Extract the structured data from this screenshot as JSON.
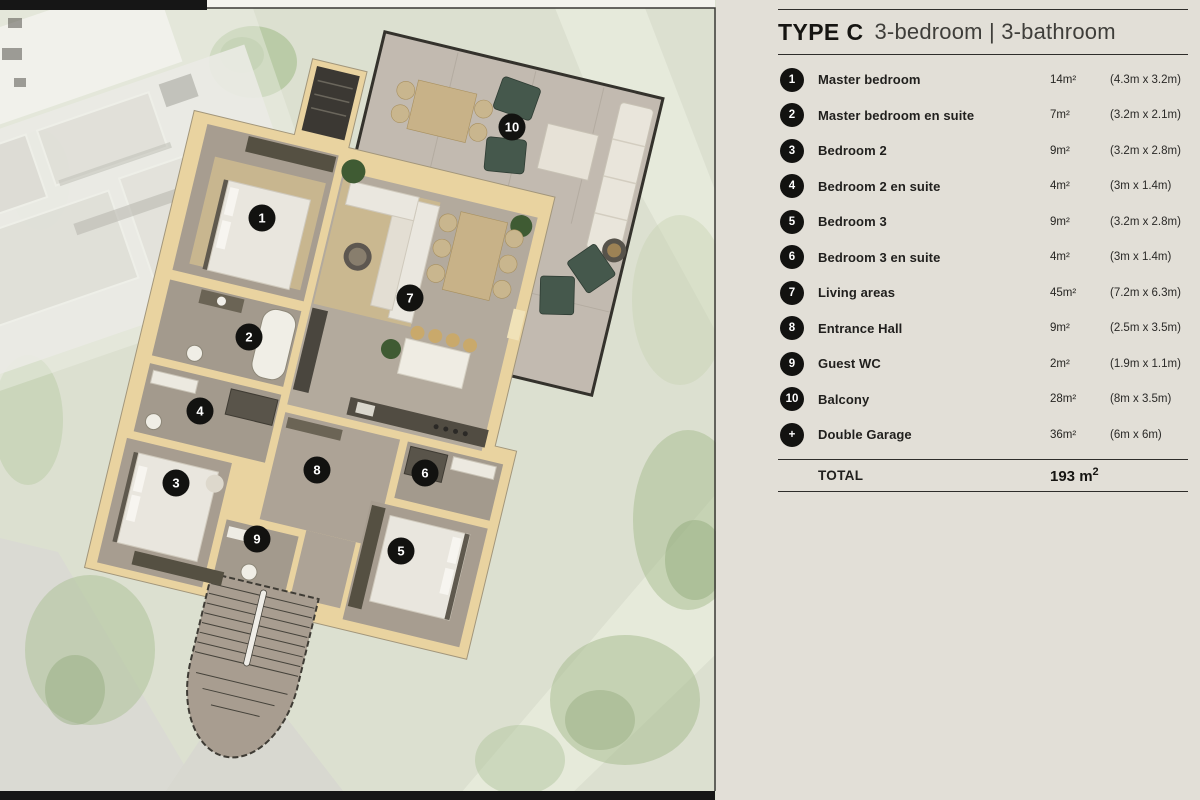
{
  "header": {
    "type": "TYPE C",
    "subtitle": "3-bedroom | 3-bathroom"
  },
  "legend": {
    "rows": [
      {
        "badge": "1",
        "name": "Master bedroom",
        "area": "14m²",
        "dims": "(4.3m x 3.2m)"
      },
      {
        "badge": "2",
        "name": "Master bedroom en suite",
        "area": "7m²",
        "dims": "(3.2m x 2.1m)"
      },
      {
        "badge": "3",
        "name": "Bedroom 2",
        "area": "9m²",
        "dims": "(3.2m x 2.8m)"
      },
      {
        "badge": "4",
        "name": "Bedroom 2 en suite",
        "area": "4m²",
        "dims": "(3m x 1.4m)"
      },
      {
        "badge": "5",
        "name": "Bedroom 3",
        "area": "9m²",
        "dims": "(3.2m x 2.8m)"
      },
      {
        "badge": "6",
        "name": "Bedroom 3 en suite",
        "area": "4m²",
        "dims": "(3m x 1.4m)"
      },
      {
        "badge": "7",
        "name": "Living areas",
        "area": "45m²",
        "dims": "(7.2m x 6.3m)"
      },
      {
        "badge": "8",
        "name": "Entrance Hall",
        "area": "9m²",
        "dims": "(2.5m x 3.5m)"
      },
      {
        "badge": "9",
        "name": "Guest WC",
        "area": "2m²",
        "dims": "(1.9m x 1.1m)"
      },
      {
        "badge": "10",
        "name": "Balcony",
        "area": "28m²",
        "dims": "(8m x 3.5m)"
      },
      {
        "badge": "+",
        "name": "Double Garage",
        "area": "36m²",
        "dims": "(6m x 6m)"
      }
    ],
    "total_label": "TOTAL",
    "total_value": "193 m",
    "total_sup": "2"
  },
  "plan": {
    "markers": [
      "1",
      "2",
      "3",
      "4",
      "5",
      "6",
      "7",
      "8",
      "9",
      "10"
    ]
  },
  "colors": {
    "panel": "#e2dfd7",
    "sage": "#dce0d0",
    "bar": "#161616",
    "frame": "#3a3835",
    "ink": "#1d1c1a",
    "badge": "#121210",
    "rule": "#2e2d2a",
    "wall": "#e9d3a0",
    "floor": "#a79d90",
    "floor_light": "#b3aa9d",
    "floor_mid": "#ada396",
    "floor_dark": "#a39a8d",
    "balcony": "#c2bab0",
    "rug": "#cdb98e",
    "teal": "#45584c",
    "plant": "#3f5b33",
    "gravel": "#dadad3",
    "tree": "#a8be92"
  }
}
